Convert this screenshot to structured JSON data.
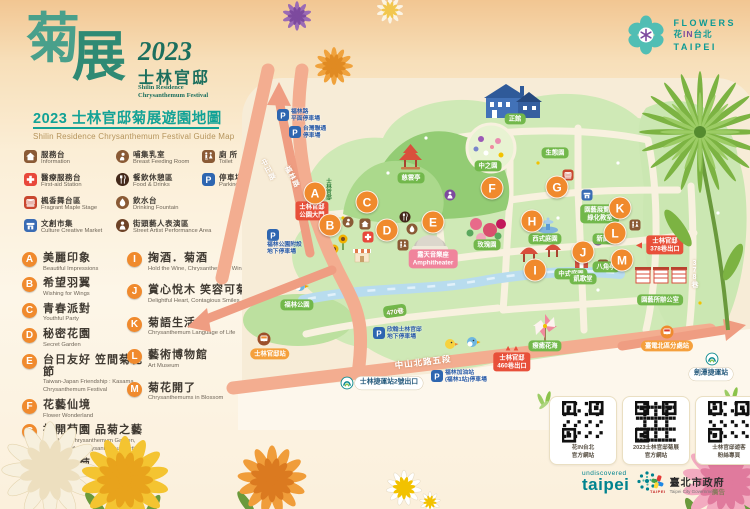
{
  "logo": {
    "main_zh_1": "菊",
    "main_zh_2": "展",
    "year": "2023",
    "site_zh": "士林官邸",
    "site_en1": "Shilin Residence",
    "site_en2": "Chrysanthemum Festival"
  },
  "title": {
    "zh": "2023 士林官邸菊展遊園地圖",
    "en": "Shilin Residence Chrysanthemum Festival Guide Map"
  },
  "brand": {
    "line1": "FLOWERS",
    "l2a": "花",
    "l2b": "IN",
    "l2c": "台北",
    "line3": "TAIPEI"
  },
  "facility_legend": {
    "col1": [
      {
        "icon": "information-icon",
        "zh": "服務台",
        "en": "Information",
        "color": "#8a5a35"
      },
      {
        "icon": "first-aid-icon",
        "zh": "醫療服務台",
        "en": "First-aid Station",
        "color": "#e8483b"
      },
      {
        "icon": "stage-icon",
        "zh": "楓香舞台區",
        "en": "Fragrant Maple Stage",
        "color": "#c9472f"
      },
      {
        "icon": "market-icon",
        "zh": "文創市集",
        "en": "Culture Creative Market",
        "color": "#3a6cb4"
      }
    ],
    "col2": [
      {
        "icon": "breast-feeding-icon",
        "zh": "哺集乳室",
        "en": "Breast Feeding Room",
        "color": "#8a5a35"
      },
      {
        "icon": "food-drinks-icon",
        "zh": "餐飲休憩區",
        "en": "Food & Drinks",
        "color": "#43281a"
      },
      {
        "icon": "drinking-fountain-icon",
        "zh": "飲水台",
        "en": "Drinking Fountain",
        "color": "#8a5a35"
      },
      {
        "icon": "street-artist-icon",
        "zh": "街頭藝人表演區",
        "en": "Street Artist Performance Area",
        "color": "#6d4226"
      }
    ],
    "col3": [
      {
        "icon": "toilet-icon",
        "zh": "廁 所",
        "en": "Toilet",
        "color": "#8a5a35"
      },
      {
        "icon": "parking-icon",
        "zh": "停車場",
        "en": "Parking Lot",
        "color": "#2e66b0"
      }
    ]
  },
  "zones": {
    "col1": [
      {
        "id": "A",
        "zh": "美麗印象",
        "en": "Beautiful Impressions"
      },
      {
        "id": "B",
        "zh": "希望羽翼",
        "en": "Wishing for Wings"
      },
      {
        "id": "C",
        "zh": "青春派對",
        "en": "Youthful Party"
      },
      {
        "id": "D",
        "zh": "秘密花園",
        "en": "Secret Garden"
      },
      {
        "id": "E",
        "zh": "台日友好 笠間菊花節",
        "en": "Taiwan-Japan Friendship : Kasama Chrysanthemum Festival"
      },
      {
        "id": "F",
        "zh": "花藝仙境",
        "en": "Flower Wonderland"
      },
      {
        "id": "G",
        "zh": "打開菊園 品菊之藝",
        "en": "Unveil the Chrysanthemum Garden, Appreciate the Chrysanthemum Artistry"
      },
      {
        "id": "H",
        "zh": "再創新菊",
        "en": "Recreating Chrysanthemums"
      }
    ],
    "col2": [
      {
        "id": "I",
        "zh": "掬酒．菊酒",
        "en": "Hold the Wine, Chrysanthemum Wine"
      },
      {
        "id": "J",
        "zh": "賞心悅木 笑容可菊",
        "en": "Delightful Heart, Contagious Smiles"
      },
      {
        "id": "K",
        "zh": "菊語生活",
        "en": "Chrysanthemum Language of Life"
      },
      {
        "id": "L",
        "zh": "藝術博物館",
        "en": "Art Museum"
      },
      {
        "id": "M",
        "zh": "菊花開了",
        "en": "Chrysanthemums in Blossom"
      }
    ]
  },
  "map": {
    "markers": [
      {
        "id": "A",
        "x": 67,
        "y": 115
      },
      {
        "id": "B",
        "x": 82,
        "y": 147
      },
      {
        "id": "C",
        "x": 119,
        "y": 124
      },
      {
        "id": "D",
        "x": 139,
        "y": 152
      },
      {
        "id": "E",
        "x": 185,
        "y": 144
      },
      {
        "id": "F",
        "x": 244,
        "y": 110
      },
      {
        "id": "G",
        "x": 309,
        "y": 109
      },
      {
        "id": "H",
        "x": 284,
        "y": 143
      },
      {
        "id": "I",
        "x": 287,
        "y": 192
      },
      {
        "id": "J",
        "x": 335,
        "y": 174
      },
      {
        "id": "K",
        "x": 372,
        "y": 130
      },
      {
        "id": "L",
        "x": 367,
        "y": 155
      },
      {
        "id": "M",
        "x": 374,
        "y": 182
      }
    ],
    "labels": [
      {
        "kind": "green",
        "text": "正館",
        "x": 267,
        "y": 41
      },
      {
        "kind": "green",
        "text": "慈雲亭",
        "x": 163,
        "y": 100
      },
      {
        "kind": "green",
        "text": "中之園",
        "x": 240,
        "y": 88
      },
      {
        "kind": "green",
        "text": "生態園",
        "x": 307,
        "y": 75
      },
      {
        "kind": "green",
        "text": "玫瑰園",
        "x": 239,
        "y": 167
      },
      {
        "kind": "green",
        "text": "西式庭園",
        "x": 297,
        "y": 161
      },
      {
        "kind": "green",
        "text": "中式庭園",
        "x": 323,
        "y": 196
      },
      {
        "kind": "green",
        "text": "凱歌堂",
        "x": 335,
        "y": 201
      },
      {
        "kind": "green",
        "text": "新蘭亭",
        "x": 358,
        "y": 161
      },
      {
        "kind": "green",
        "text": "八角亭",
        "x": 358,
        "y": 189
      },
      {
        "kind": "green",
        "text": "園藝展覽館",
        "text2": "綠化教室",
        "x": 352,
        "y": 136
      },
      {
        "kind": "green",
        "text": "園藝所辦公室",
        "x": 412,
        "y": 222
      },
      {
        "kind": "green",
        "text": "福林公園",
        "x": 49,
        "y": 227
      },
      {
        "kind": "green",
        "text": "療癒花海",
        "x": 297,
        "y": 268
      },
      {
        "kind": "pink",
        "text": "露天音樂座",
        "text2": "Amphitheater",
        "x": 185,
        "y": 181
      },
      {
        "kind": "red",
        "text": "士林官邸",
        "text2": "公園大門",
        "x": 64,
        "y": 133
      },
      {
        "kind": "red",
        "text": "士林官邸",
        "text2": "378巷出口",
        "x": 417,
        "y": 167,
        "arrow": "left"
      },
      {
        "kind": "red",
        "text": "士林官邸",
        "text2": "460巷出口",
        "x": 264,
        "y": 284,
        "arrow": "up"
      },
      {
        "kind": "orange",
        "text": "士林官邸站",
        "x": 22,
        "y": 276
      },
      {
        "kind": "orange",
        "text": "臺電北區分處站",
        "x": 419,
        "y": 268
      },
      {
        "kind": "white",
        "text": "士林捷運站2號出口",
        "x": 141,
        "y": 305
      },
      {
        "kind": "white",
        "text": "劍潭捷運站",
        "x": 463,
        "y": 296
      }
    ],
    "parkings": [
      {
        "lines": [
          "福林路",
          "平面停車場"
        ],
        "x": 35,
        "y": 37,
        "layout": "right"
      },
      {
        "lines": [
          "台灣聯通",
          "停車場"
        ],
        "x": 47,
        "y": 54,
        "layout": "right"
      },
      {
        "lines": [
          "福林公園附設",
          "地下停車場"
        ],
        "x": 25,
        "y": 157,
        "layout": "below"
      },
      {
        "lines": [
          "欣翰士林官邸",
          "地下停車場"
        ],
        "x": 131,
        "y": 255,
        "layout": "right"
      },
      {
        "lines": [
          "福林加油站",
          "(福林1站)停車場"
        ],
        "x": 189,
        "y": 298,
        "layout": "right"
      }
    ],
    "roads": [
      {
        "text": "中正路",
        "x": 20,
        "y": 92,
        "rot": 62,
        "size": 7
      },
      {
        "text": "福林路",
        "x": 44,
        "y": 99,
        "rot": 62,
        "size": 7
      },
      {
        "text": "中山北路五段",
        "x": 175,
        "y": 284,
        "rot": -7,
        "size": 8.5
      },
      {
        "text": "470巷",
        "x": 147,
        "y": 233,
        "rot": -8,
        "size": 6.5,
        "pill": true
      },
      {
        "text": "378巷",
        "x": 446,
        "y": 196,
        "vertical": true,
        "size": 7
      },
      {
        "text": "士林官邸",
        "x": 80,
        "y": 111,
        "vertical": true,
        "size": 5.5,
        "color": "#2f7d3a"
      }
    ],
    "icons": [
      {
        "t": "information-icon",
        "x": 117,
        "y": 146
      },
      {
        "t": "first-aid-icon",
        "x": 120,
        "y": 159
      },
      {
        "t": "breast-feeding-icon",
        "x": 100,
        "y": 144
      },
      {
        "t": "food-drinks-icon",
        "x": 157,
        "y": 139
      },
      {
        "t": "drinking-fountain-icon",
        "x": 164,
        "y": 151
      },
      {
        "t": "toilet-icon",
        "x": 155,
        "y": 167
      },
      {
        "t": "toilet-icon",
        "x": 387,
        "y": 147
      },
      {
        "t": "toilet-icon",
        "x": 355,
        "y": 187
      },
      {
        "t": "street-artist-icon",
        "x": 202,
        "y": 117,
        "c": "#7d4a9e"
      },
      {
        "t": "street-artist-icon",
        "x": 347,
        "y": 134,
        "c": "#7d4a9e"
      },
      {
        "t": "street-artist-icon",
        "x": 350,
        "y": 162,
        "c": "#7d4a9e"
      },
      {
        "t": "stage-icon",
        "x": 320,
        "y": 97
      },
      {
        "t": "market-icon",
        "x": 339,
        "y": 117
      },
      {
        "t": "bus-icon",
        "x": 16,
        "y": 261,
        "c": "#9c4f2a",
        "c2": "#ef8a2e"
      },
      {
        "t": "bus-icon",
        "x": 419,
        "y": 254,
        "c": "#ef8a2e",
        "c2": "#d93a2b"
      },
      {
        "t": "mrt-icon",
        "x": 99,
        "y": 305
      },
      {
        "t": "mrt-icon",
        "x": 464,
        "y": 281
      }
    ]
  },
  "qr": {
    "cards": [
      [
        "花IN台北",
        "官方網站"
      ],
      [
        "2023士林官邸菊展",
        "官方網站"
      ],
      [
        "士林官邸遊客",
        "粉絲專頁"
      ]
    ]
  },
  "footer": {
    "undiscovered": "undiscovered",
    "taipei_lower": "taipei",
    "brand_mark": "TAIPEI",
    "gov_zh": "臺北市政府",
    "gov_en": "Taipei City Government",
    "ad": "廣告"
  }
}
